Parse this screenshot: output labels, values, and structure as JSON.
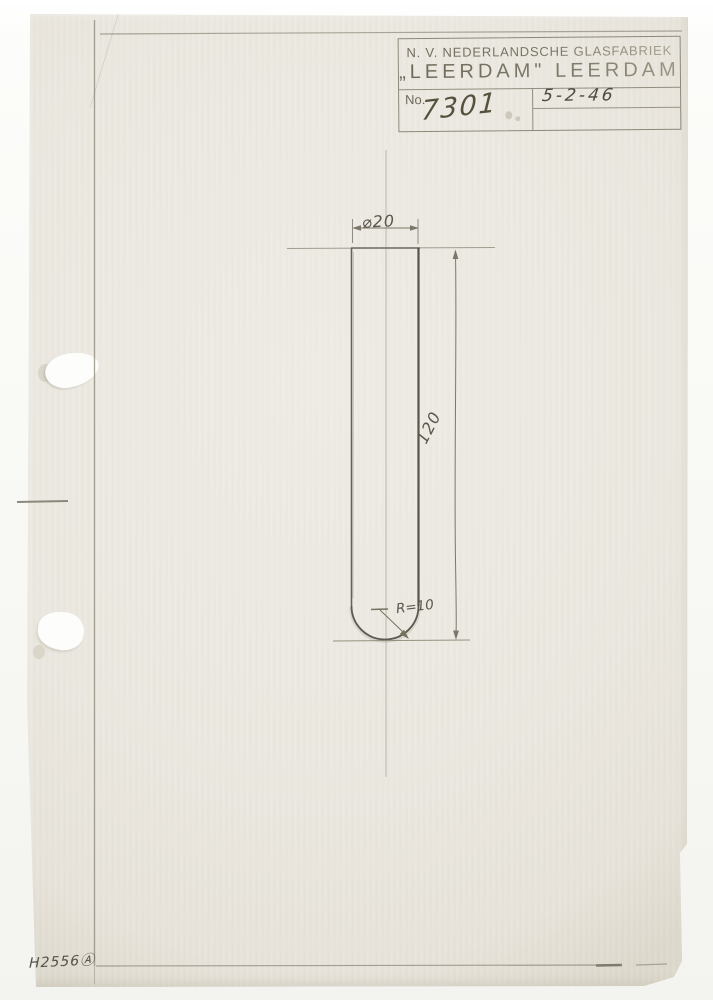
{
  "document": {
    "type": "scanned technical drawing sheet",
    "company_line1": "N. V. NEDERLANDSCHE GLASFABRIEK",
    "company_line2": "„LEERDAM\" LEERDAM",
    "number_label": "No.",
    "number_value": "7301",
    "date_value": "5-2-46"
  },
  "drawing": {
    "subject": "test-tube outline with centerline and dimensions",
    "diameter_label": "⌀20",
    "length_label": "120",
    "radius_label": "R=10"
  },
  "annotations": {
    "corner_mark": "H2556Ⓐ"
  },
  "colors": {
    "background": "#fcfcfb",
    "paper": "#ebe8e0",
    "pencil": "#8b8779",
    "dark_pencil": "#57544c",
    "stamp_ink": "#7b7667",
    "handwriting": "#56513f"
  }
}
